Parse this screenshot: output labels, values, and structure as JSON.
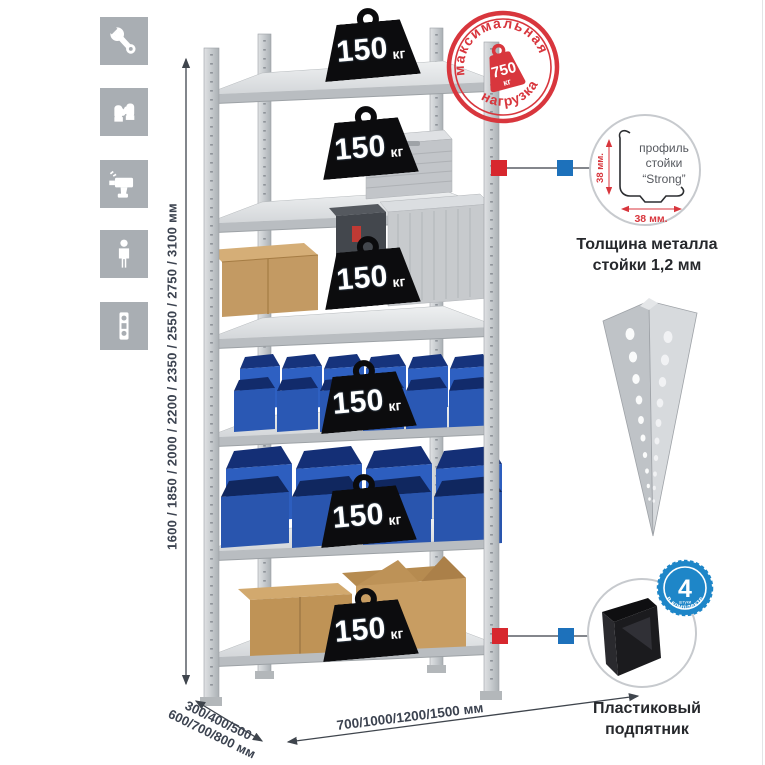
{
  "page": {
    "background": "#ffffff"
  },
  "sidebar": {
    "tiles": [
      {
        "icon": "wrench"
      },
      {
        "icon": "work-gloves"
      },
      {
        "icon": "drill"
      },
      {
        "icon": "person-height"
      },
      {
        "icon": "spirit-level"
      }
    ]
  },
  "rack": {
    "shelf_count": 6,
    "shelves": [
      {
        "load": "150",
        "unit": "кг"
      },
      {
        "load": "150",
        "unit": "кг"
      },
      {
        "load": "150",
        "unit": "кг"
      },
      {
        "load": "150",
        "unit": "кг"
      },
      {
        "load": "150",
        "unit": "кг"
      },
      {
        "load": "150",
        "unit": "кг"
      }
    ]
  },
  "stamp": {
    "arc_top": "максимальная",
    "arc_bottom": "нагрузка",
    "value": "750",
    "unit": "кг"
  },
  "dimensions": {
    "height": "1600 / 1850 / 2000 / 2200 / 2350 / 2550 / 2750 / 3100 мм",
    "depth_line1": "300/400/500",
    "depth_line2": "600/700/800 мм",
    "width": "700/1000/1200/1500 мм"
  },
  "profile_detail": {
    "line1": "профиль",
    "line2": "стойки",
    "line3": "“Strong”",
    "dim_vertical": "38 мм.",
    "dim_horizontal": "38 мм.",
    "caption_line1": "Толщина металла",
    "caption_line2": "стойки 1,2 мм"
  },
  "foot_detail": {
    "badge_number": "4",
    "badge_word": "штуки",
    "badge_arc": "в комплекте",
    "caption_line1": "Пластиковый",
    "caption_line2": "подпятник"
  },
  "colors": {
    "stamp_red": "#d8363d",
    "marker_red": "#d7272e",
    "marker_blue": "#1d71bb",
    "badge_blue": "#1e86c8",
    "bin_blue": "#2d5ebf",
    "metal_gray": "#ccd0d3",
    "cardboard": "#c39a63",
    "tile_gray": "#a9aeb3",
    "text_dark": "#3c4350"
  }
}
